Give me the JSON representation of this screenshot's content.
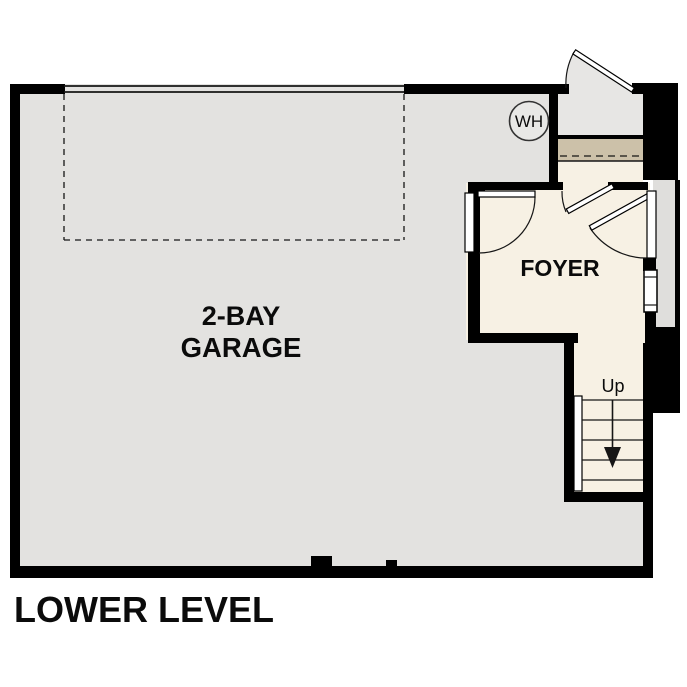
{
  "plan": {
    "floor_title": "LOWER LEVEL",
    "rooms": {
      "garage": {
        "label_line1": "2-BAY",
        "label_line2": "GARAGE"
      },
      "foyer": {
        "label": "FOYER"
      }
    },
    "stairs": {
      "direction_label": "Up"
    },
    "fixtures": {
      "water_heater_label": "WH"
    }
  },
  "colors": {
    "background": "#ffffff",
    "wall": "#000000",
    "line": "#161616",
    "garage_floor": "#e3e2e0",
    "foyer_floor": "#f7f1e4",
    "stair_floor": "#f7f1e4",
    "entry_stoop": "#e7e6e4",
    "threshold": "#ccc1a9",
    "exterior_landing": "#dfdedc",
    "water_heater_fill": "#e8e8e6",
    "door_leaf_fill": "#ffffff"
  }
}
